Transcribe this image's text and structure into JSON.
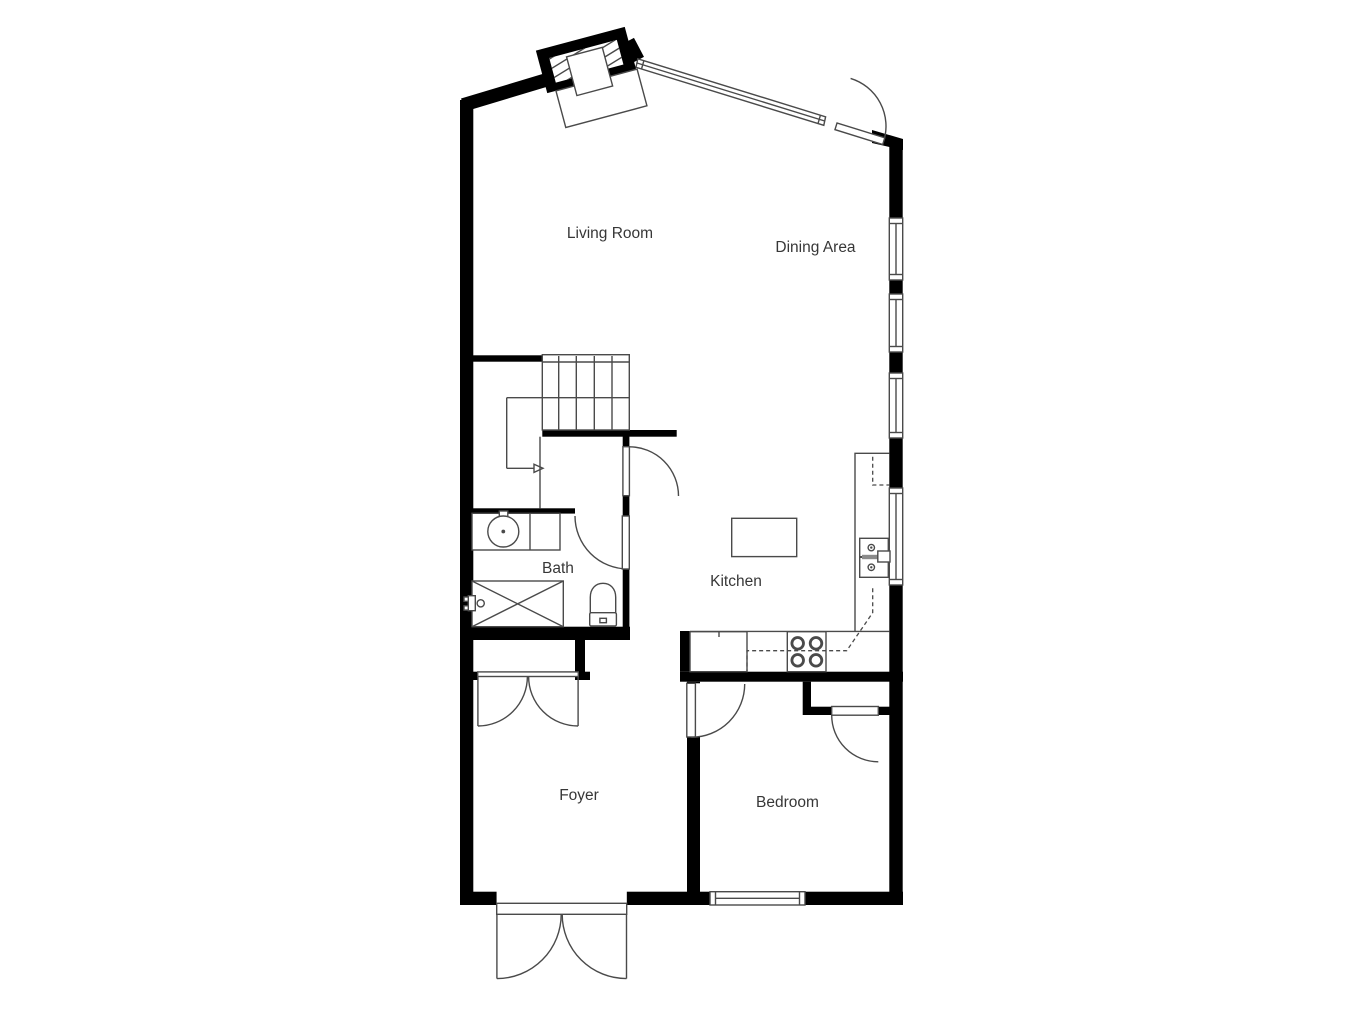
{
  "floorplan": {
    "type": "floor-plan",
    "rooms": [
      {
        "label": "Living Room"
      },
      {
        "label": "Dining Area"
      },
      {
        "label": "Bath"
      },
      {
        "label": "Kitchen"
      },
      {
        "label": "Foyer"
      },
      {
        "label": "Bedroom"
      }
    ],
    "fixtures": [
      "fireplace",
      "stairs",
      "bathtub",
      "toilet",
      "vanity-sink",
      "kitchen-sink",
      "stove",
      "refrigerator",
      "kitchen-island",
      "kitchen-counter"
    ],
    "doors": [
      "entry-double-door",
      "dining-area-door",
      "foyer-closet-double-door",
      "bedroom-door",
      "bedroom-closet-door",
      "bath-door",
      "understair-closet-door"
    ],
    "windows_count": 6,
    "colors": {
      "wall": "#000000",
      "line": "#4a4a4a",
      "label": "#373737",
      "background": "#ffffff"
    }
  }
}
